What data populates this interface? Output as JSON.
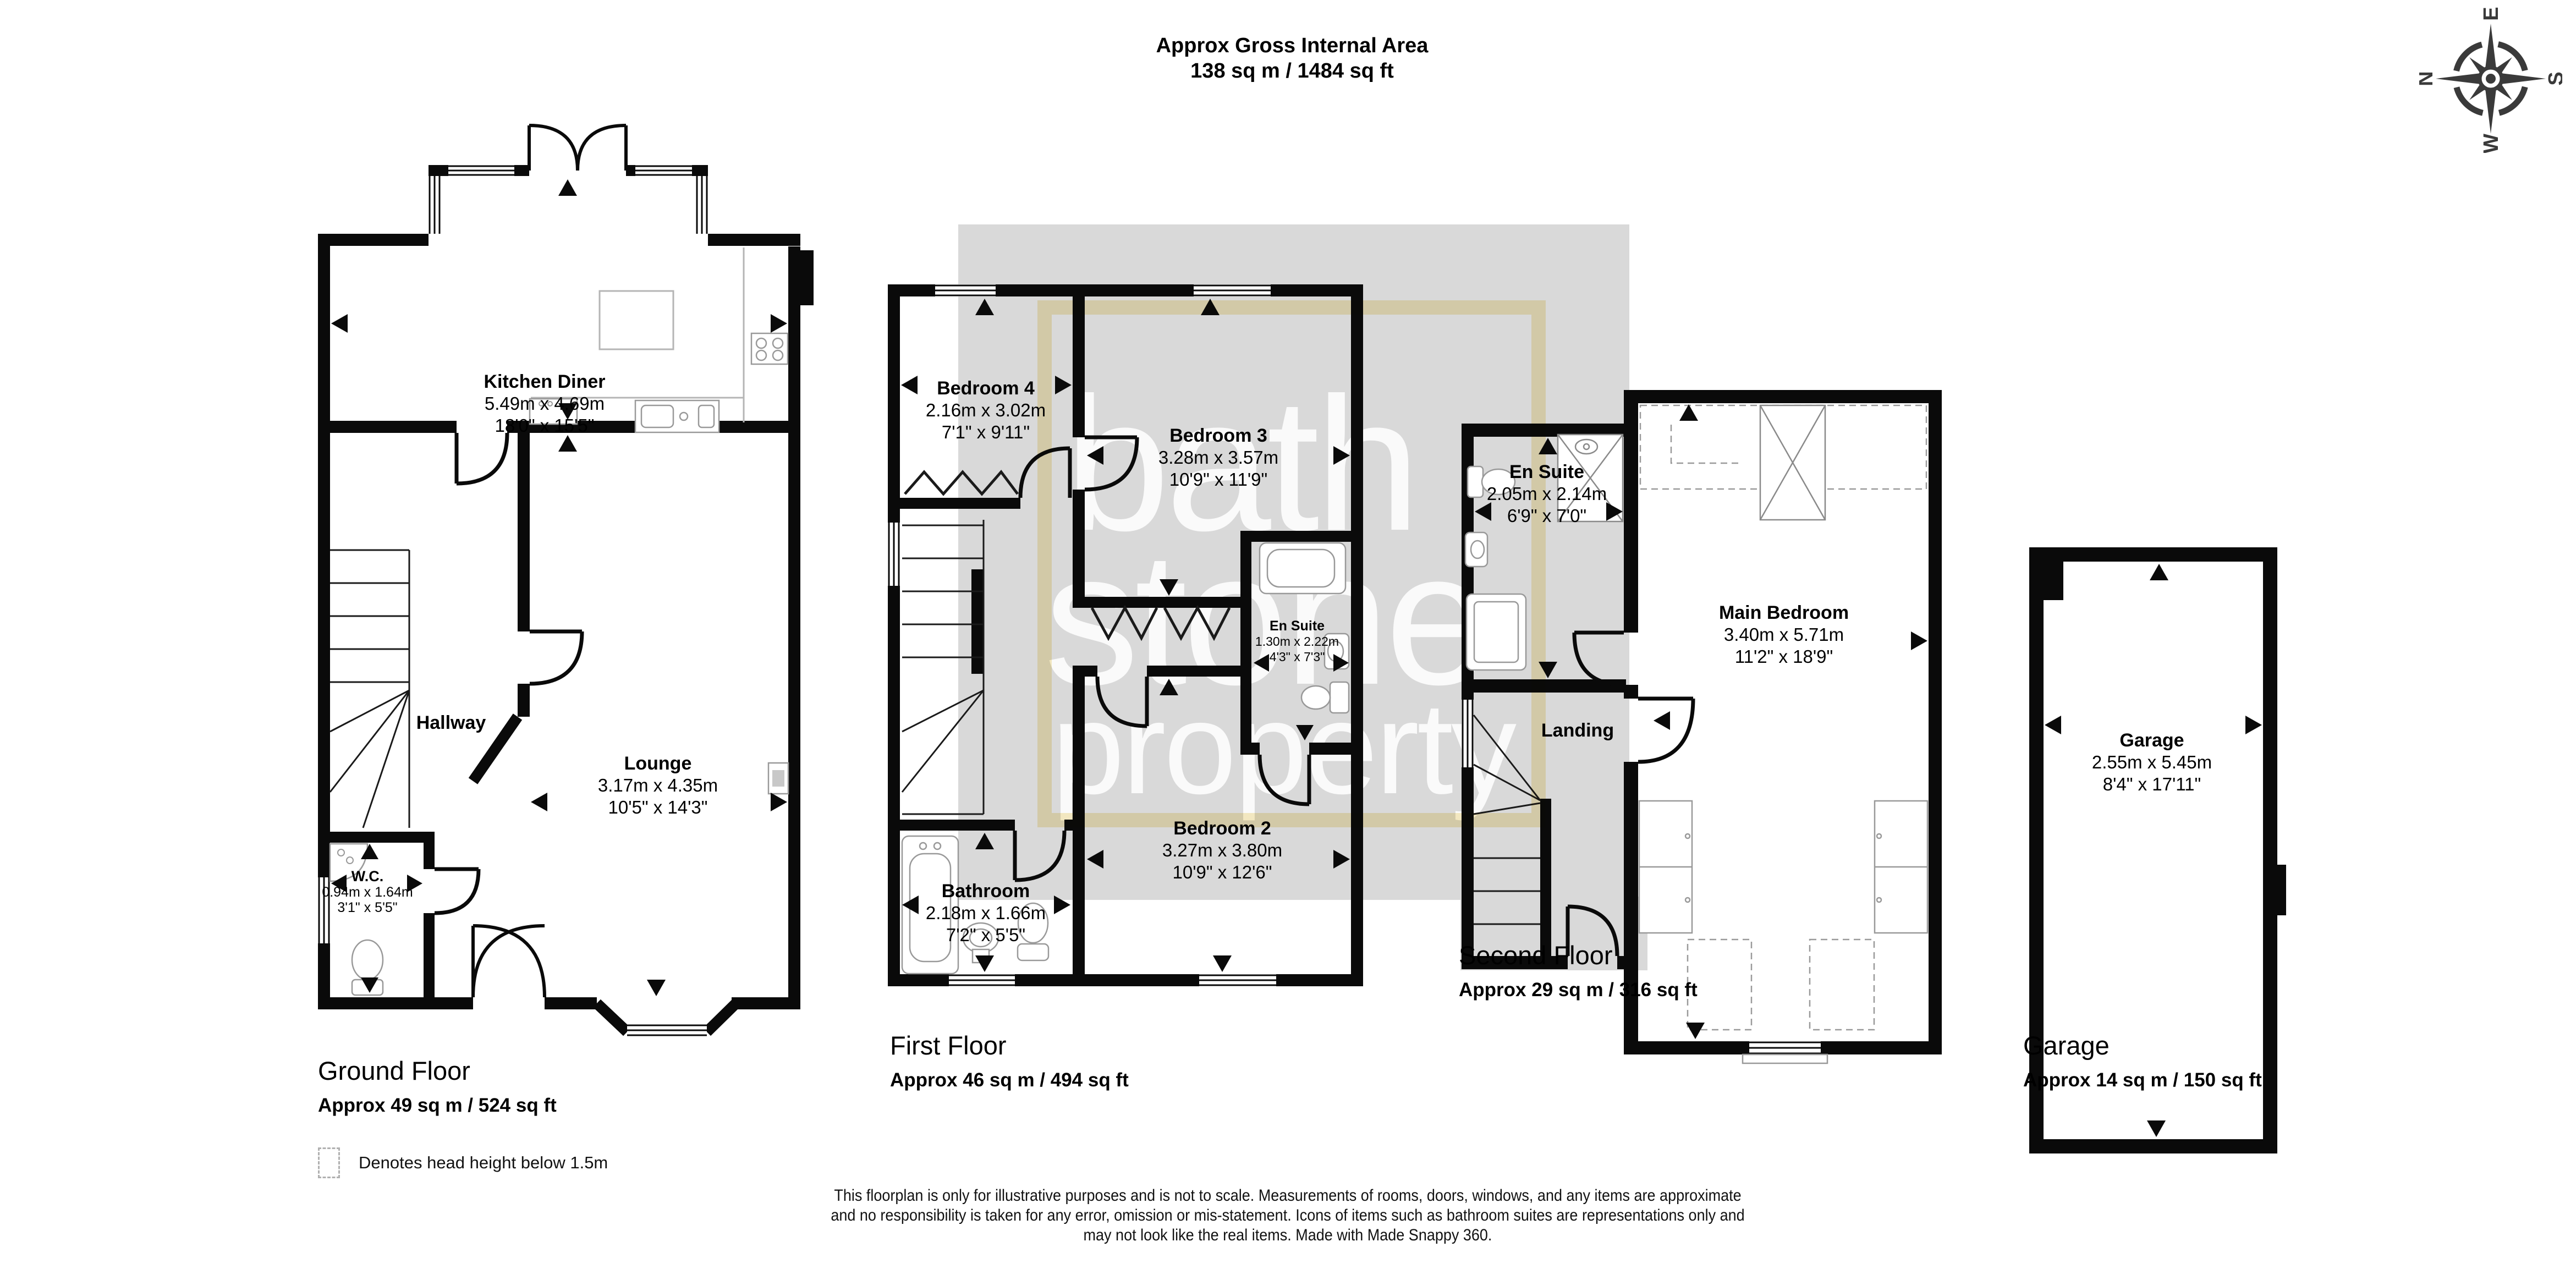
{
  "title": {
    "line1": "Approx Gross Internal Area",
    "line2": "138 sq m / 1484 sq ft"
  },
  "compass": {
    "north": "N",
    "east": "E",
    "south": "S",
    "west": "W"
  },
  "watermark": {
    "line1": "bath",
    "line2": "stone",
    "line3": "property"
  },
  "legend": {
    "text": "Denotes head height below 1.5m"
  },
  "colors": {
    "wall": "#0a0a0a",
    "shadow_gray": "#d9d9d9",
    "highlight_yellow": "#f7ecc4",
    "fixture_gray": "#999999"
  },
  "floors": {
    "ground": {
      "label": "Ground Floor",
      "area": "Approx 49 sq m / 524 sq ft",
      "rooms": {
        "kitchen_diner": {
          "name": "Kitchen Diner",
          "metric": "5.49m x 4.69m",
          "imperial": "18'0\" x 15'5\""
        },
        "hallway": {
          "name": "Hallway"
        },
        "lounge": {
          "name": "Lounge",
          "metric": "3.17m x 4.35m",
          "imperial": "10'5\" x 14'3\""
        },
        "wc": {
          "name": "W.C.",
          "metric": "0.94m x 1.64m",
          "imperial": "3'1\" x 5'5\""
        }
      }
    },
    "first": {
      "label": "First Floor",
      "area": "Approx 46 sq m / 494 sq ft",
      "rooms": {
        "bedroom4": {
          "name": "Bedroom 4",
          "metric": "2.16m x 3.02m",
          "imperial": "7'1\" x 9'11\""
        },
        "bedroom3": {
          "name": "Bedroom 3",
          "metric": "3.28m x 3.57m",
          "imperial": "10'9\" x 11'9\""
        },
        "en_suite": {
          "name": "En Suite",
          "metric": "1.30m x 2.22m",
          "imperial": "4'3\" x 7'3\""
        },
        "bathroom": {
          "name": "Bathroom",
          "metric": "2.18m x 1.66m",
          "imperial": "7'2\" x 5'5\""
        },
        "bedroom2": {
          "name": "Bedroom 2",
          "metric": "3.27m x 3.80m",
          "imperial": "10'9\" x 12'6\""
        }
      }
    },
    "second": {
      "label": "Second Floor",
      "area": "Approx 29 sq m / 316 sq ft",
      "rooms": {
        "en_suite": {
          "name": "En Suite",
          "metric": "2.05m x 2.14m",
          "imperial": "6'9\" x 7'0\""
        },
        "landing": {
          "name": "Landing"
        },
        "main_bedroom": {
          "name": "Main Bedroom",
          "metric": "3.40m x 5.71m",
          "imperial": "11'2\" x 18'9\""
        }
      }
    },
    "garage": {
      "label": "Garage",
      "area": "Approx 14 sq m / 150 sq ft",
      "rooms": {
        "garage": {
          "name": "Garage",
          "metric": "2.55m x 5.45m",
          "imperial": "8'4\" x 17'11\""
        }
      }
    }
  },
  "disclaimer": {
    "line1": "This floorplan is only for illustrative purposes and is not to scale. Measurements of rooms, doors, windows, and any items are approximate",
    "line2": "and no responsibility is taken for any error, omission or mis-statement. Icons of items such as bathroom suites are representations only and",
    "line3": "may not look like the real items. Made with Made Snappy 360."
  }
}
